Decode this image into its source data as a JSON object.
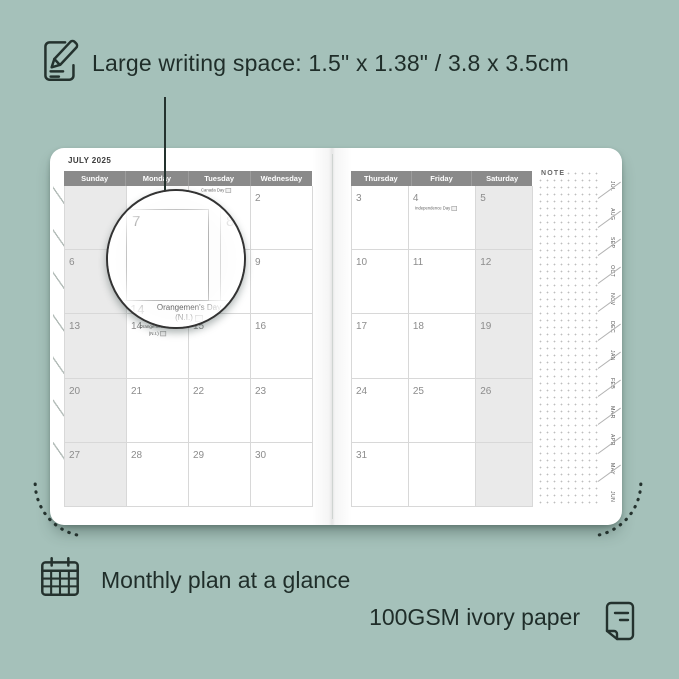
{
  "features": {
    "writing_space": "Large writing space: 1.5\" x 1.38\" / 3.8 x 3.5cm",
    "monthly_glance": "Monthly plan at a glance",
    "paper": "100GSM ivory paper"
  },
  "calendar": {
    "month_title": "JULY 2025",
    "left_day_headers": [
      "Sunday",
      "Monday",
      "Tuesday",
      "Wednesday"
    ],
    "right_day_headers": [
      "Thursday",
      "Friday",
      "Saturday"
    ],
    "note_label": "NOTE",
    "left_dates": [
      [
        "",
        "",
        "1",
        "2"
      ],
      [
        "6",
        "7",
        "8",
        "9"
      ],
      [
        "13",
        "14",
        "15",
        "16"
      ],
      [
        "20",
        "21",
        "22",
        "23"
      ],
      [
        "27",
        "28",
        "29",
        "30"
      ]
    ],
    "right_dates": [
      [
        "3",
        "4",
        "5"
      ],
      [
        "10",
        "11",
        "12"
      ],
      [
        "17",
        "18",
        "19"
      ],
      [
        "24",
        "25",
        "26"
      ],
      [
        "31",
        "",
        ""
      ]
    ],
    "holidays": {
      "canada": "Canada Day",
      "independence": "Independence Day",
      "orangemens": "Orangemen's Day",
      "orangemens_region": "(N.I.)"
    },
    "tabs": [
      "JUL",
      "AUG",
      "SEP",
      "OCT",
      "NOV",
      "DEC",
      "JAN",
      "FEB",
      "MAR",
      "APR",
      "MAY",
      "JUN"
    ]
  },
  "magnifier": {
    "large_date": "7",
    "right_date": "8",
    "bottom_date": "14",
    "holiday_name": "Orangemen's Day",
    "holiday_region": "(N.I.)"
  },
  "icons": {
    "top": "pencil-note-icon",
    "monthly": "calendar-grid-icon",
    "paper": "paper-sheet-icon"
  },
  "colors": {
    "background": "#a5c1ba",
    "ink": "#24322e",
    "header_bar": "#8a8a8a",
    "shaded_column": "#eaeaea",
    "grid_line": "#d8d8d8",
    "page": "#ffffff"
  }
}
